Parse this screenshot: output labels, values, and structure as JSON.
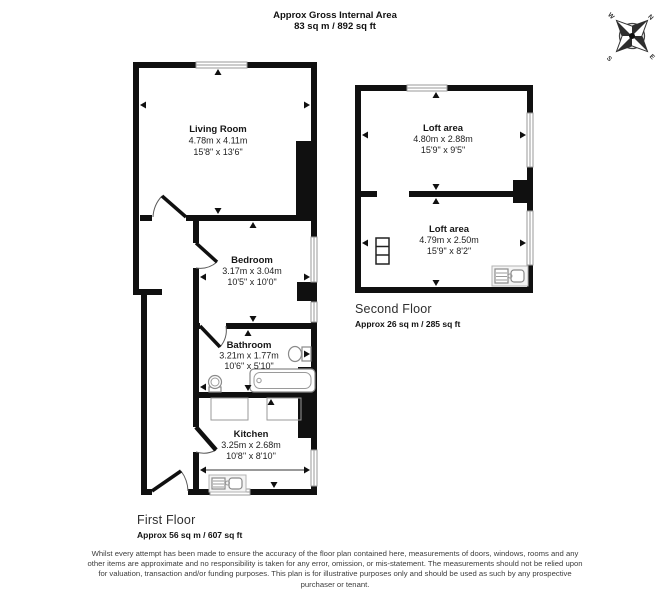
{
  "header": {
    "title": "Approx Gross Internal Area",
    "subtitle": "83 sq m / 892 sq ft"
  },
  "compass": {
    "n": "N",
    "e": "E",
    "s": "S",
    "w": "W"
  },
  "floors": {
    "first": {
      "name": "First Floor",
      "area": "Approx 56 sq m / 607 sq ft",
      "rooms": [
        {
          "name": "Living Room",
          "metric": "4.78m x 4.11m",
          "imperial": "15'8\" x 13'6\""
        },
        {
          "name": "Bedroom",
          "metric": "3.17m x 3.04m",
          "imperial": "10'5\" x 10'0\""
        },
        {
          "name": "Bathroom",
          "metric": "3.21m x 1.77m",
          "imperial": "10'6\" x 5'10\""
        },
        {
          "name": "Kitchen",
          "metric": "3.25m x 2.68m",
          "imperial": "10'8'' x 8'10''"
        }
      ]
    },
    "second": {
      "name": "Second Floor",
      "area": "Approx 26 sq m / 285 sq ft",
      "rooms": [
        {
          "name": "Loft area",
          "metric": "4.80m x 2.88m",
          "imperial": "15'9\" x 9'5\""
        },
        {
          "name": "Loft area",
          "metric": "4.79m x 2.50m",
          "imperial": "15'9\" x 8'2\""
        }
      ]
    }
  },
  "disclaimer": "Whilst every attempt has been made to ensure the accuracy of the floor plan contained here, measurements of doors, windows, rooms and any other items are approximate and no responsibility is taken for any error, omission, or mis-statement. The measurements should not be relied upon for valuation, transaction and/or funding purposes. This plan is for illustrative purposes only and should be used as such by any prospective purchaser or tenant."
}
